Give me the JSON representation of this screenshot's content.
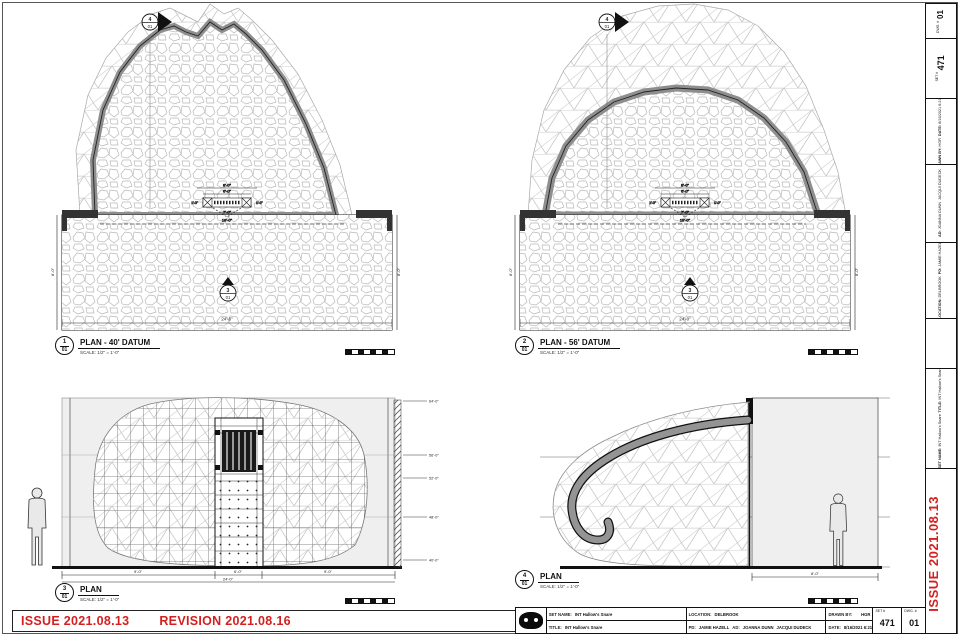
{
  "sheet": {
    "issue": {
      "issue_text": "ISSUE 2021.08.13",
      "revision_text": "REVISION 2021.08.16"
    },
    "side_issue_text": "ISSUE 2021.08.13",
    "colors": {
      "issue_red": "#d41f1f",
      "band_gray": "#8e8e8e",
      "wall_fill": "#efefef"
    }
  },
  "titleblock": {
    "set_name_label": "SET NAME:",
    "set_name": "INT Hallow's Snare",
    "title_label": "TITLE:",
    "title": "INT Hallow's Snare",
    "location_label": "LOCATION:",
    "location": "DELBROOK",
    "pd_label": "PD:",
    "pd": "JAMIE HAZELL",
    "ad_label": "AD:",
    "ad1": "JOANNA DUNN",
    "ad2": "JACQUI DUDECK",
    "drawn_by_label": "DRAWN BY:",
    "drawn_by": "HGR",
    "date_label": "DATE:",
    "date": "8/16/2021 6:21:13",
    "set_no_label": "SET #",
    "set_no": "471",
    "dwg_no_label": "DWG. #",
    "dwg_no": "01"
  },
  "views": {
    "v1": {
      "num": "1",
      "ref": "01",
      "title": "PLAN - 40' DATUM",
      "scale": "SCALE: 1/2\" = 1'-0\""
    },
    "v2": {
      "num": "2",
      "ref": "01",
      "title": "PLAN - 56' DATUM",
      "scale": "SCALE: 1/2\" = 1'-0\""
    },
    "v3": {
      "num": "3",
      "ref": "01",
      "title": "PLAN",
      "scale": "SCALE: 1/2\" = 1'-0\""
    },
    "v4": {
      "num": "4",
      "ref": "01",
      "title": "PLAN",
      "scale": "SCALE: 1/2\" = 1'-0\""
    }
  },
  "markers": {
    "top_section": {
      "num": "4",
      "ref": "01"
    },
    "plan_section": {
      "num": "3",
      "ref": "01"
    }
  },
  "dims": {
    "v1": {
      "overall": "24'-0\"",
      "mid": "18'-0\"",
      "side_left": "8'-0\"",
      "side_right": "8'-0\"",
      "door_top": "8'-0\"",
      "door_mid": "6'-0\"",
      "door_side_l": "1'-0\"",
      "door_side_r": "1'-0\"",
      "door_low": "7'-0\"",
      "door_bottom": "10'-0\""
    },
    "v2": {
      "overall": "24'-0\"",
      "mid": "18'-0\"",
      "side_left": "8'-0\"",
      "side_right": "8'-0\"",
      "door_top": "8'-0\"",
      "door_mid": "6'-0\"",
      "door_side_l": "1'-0\"",
      "door_side_r": "1'-0\"",
      "door_low": "7'-0\"",
      "door_bottom": "10'-0\""
    },
    "v3": {
      "seg_a": "9'-0\"",
      "seg_b": "6'-0\"",
      "seg_c": "9'-0\"",
      "overall": "24'-0\""
    },
    "v4": {
      "room": "8'-0\""
    }
  },
  "elevations": {
    "labels": [
      "64'-0\"",
      "56'-0\"",
      "52'-0\"",
      "48'-0\"",
      "40'-0\""
    ]
  }
}
